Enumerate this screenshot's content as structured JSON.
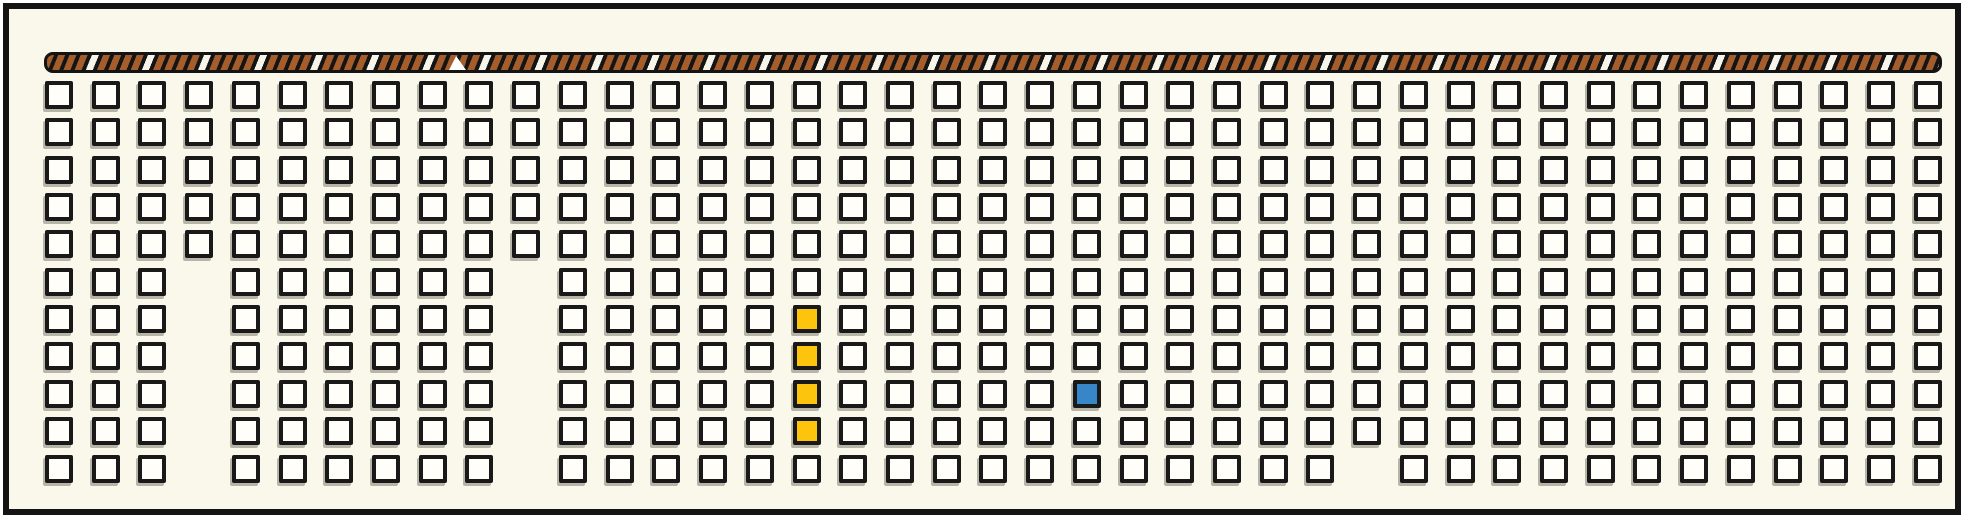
{
  "panel": {
    "background_color": "#faf8eb",
    "frame_color": "#141414",
    "outer_background": "#ffffff"
  },
  "palette": {
    "yellow": "#fcc40d",
    "blue": "#3787c8",
    "tile_fill": "#fffef8",
    "tile_border": "#191919",
    "rope_brown": "#a55d2c",
    "rope_white": "#f7f4ea",
    "rope_black": "#141414"
  },
  "rope": {
    "x": 35,
    "y": 43,
    "width": 1898,
    "height": 21,
    "seam_x": 447,
    "description": "striped rope barrier band across the top"
  },
  "grid": {
    "rows": 11,
    "cols": 41,
    "origin_x": 36,
    "origin_y": 72,
    "pitch_x": 46.72,
    "pitch_y": 37.35,
    "cell_size": 28,
    "missing_cells": [
      {
        "col": 3,
        "rows": [
          5,
          6,
          7,
          8,
          9,
          10
        ]
      },
      {
        "col": 10,
        "rows": [
          5,
          6,
          7,
          8,
          9,
          10
        ]
      },
      {
        "col": 28,
        "rows": [
          10
        ]
      }
    ],
    "colored_cells": [
      {
        "col": 16,
        "row": 6,
        "color_key": "yellow"
      },
      {
        "col": 16,
        "row": 7,
        "color_key": "yellow"
      },
      {
        "col": 16,
        "row": 8,
        "color_key": "yellow"
      },
      {
        "col": 16,
        "row": 9,
        "color_key": "yellow"
      },
      {
        "col": 22,
        "row": 8,
        "color_key": "blue"
      }
    ],
    "tile_counts": {
      "total_tiles": 438,
      "yellow_tiles": 4,
      "blue_tiles": 1,
      "white_tiles": 433
    }
  }
}
